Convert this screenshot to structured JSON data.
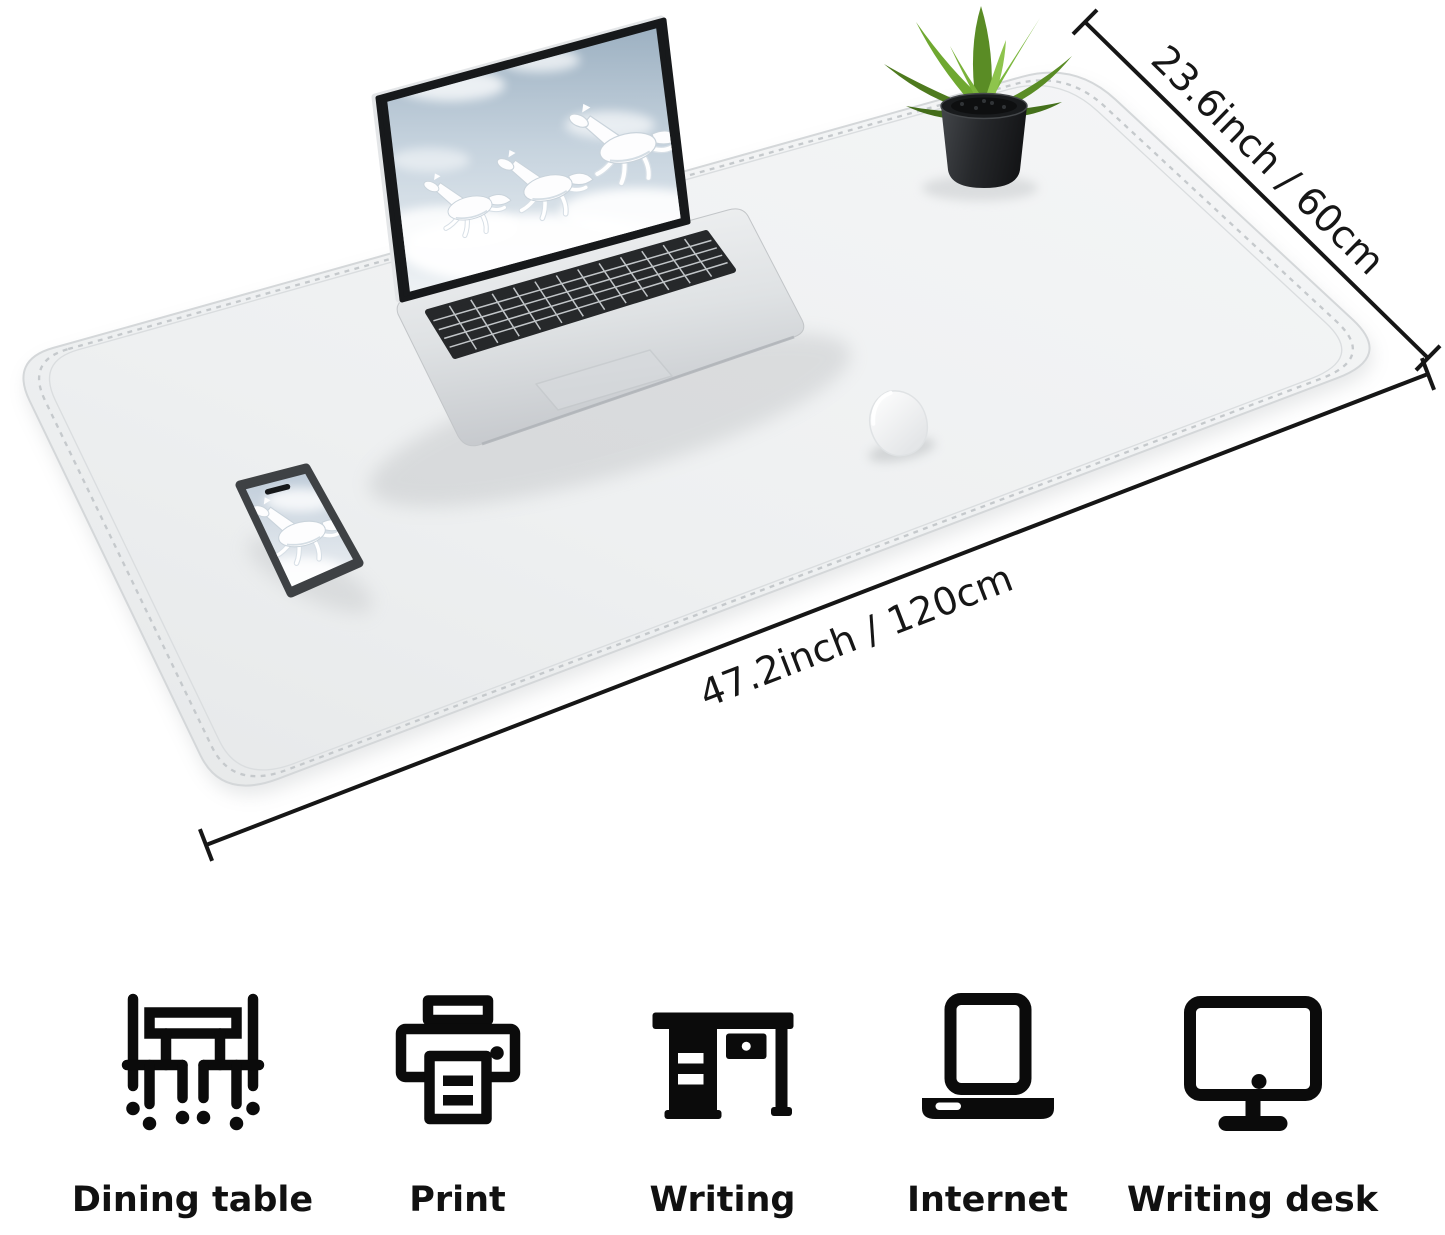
{
  "product_image": {
    "background_color": "#ffffff",
    "mat": {
      "label": "desk mat",
      "color": "#eef0f1",
      "stitch_color": "#c6cacd"
    },
    "objects": [
      "laptop-with-white-horses-wallpaper",
      "smartphone-with-white-horse-wallpaper",
      "white-wireless-mouse",
      "potted-green-plant"
    ],
    "dimensions": {
      "depth_label": "23.6inch / 60cm",
      "width_label": "47.2inch / 120cm",
      "line_color": "#161616"
    }
  },
  "features": [
    {
      "icon": "dining-table-icon",
      "label": "Dining table"
    },
    {
      "icon": "printer-icon",
      "label": "Print"
    },
    {
      "icon": "desk-icon",
      "label": "Writing"
    },
    {
      "icon": "laptop-icon",
      "label": "Internet"
    },
    {
      "icon": "monitor-icon",
      "label": "Writing desk"
    }
  ],
  "style": {
    "icon_color": "#0b0b0b",
    "label_color": "#111111",
    "leaf_green": "#6fa830",
    "laptop_silver": "#d9dcde",
    "key_color": "#26282a"
  }
}
